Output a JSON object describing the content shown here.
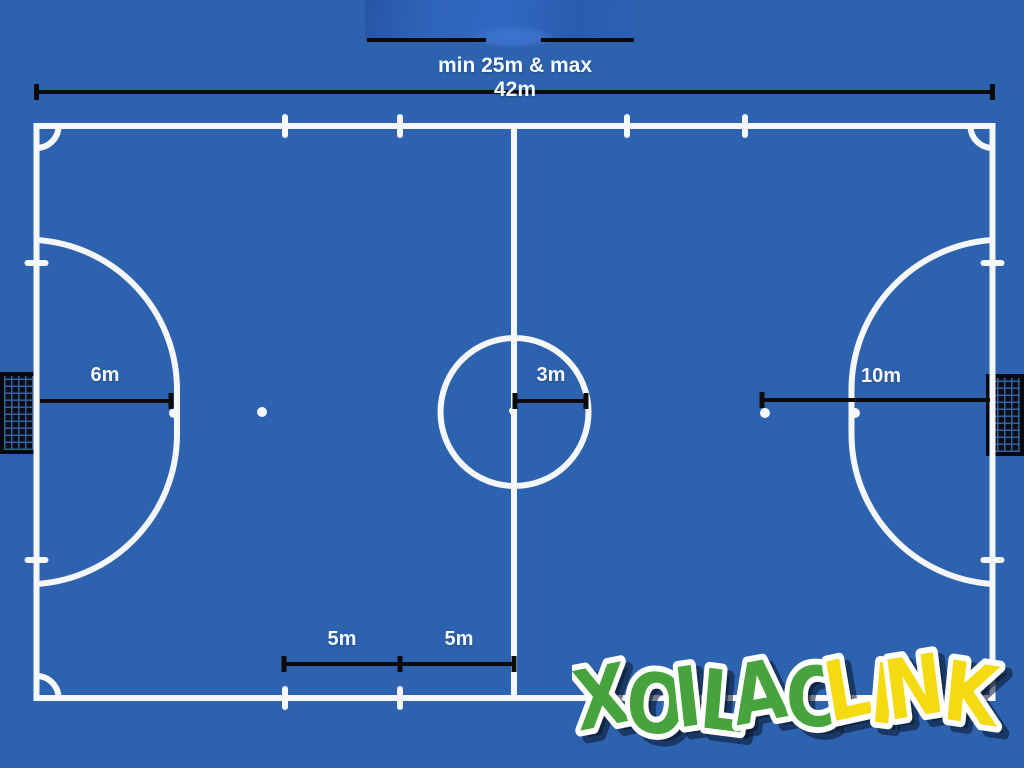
{
  "colors": {
    "background": "#2d63ae",
    "court_line_white": "#f5f7fa",
    "dimension_black": "#0b0b0c",
    "goal_frame_black": "#060a10",
    "goal_net_blue": "#35619f",
    "logo_green": "#47a33d",
    "logo_yellow": "#f3da11",
    "logo_outline": "#ffffff"
  },
  "dimensions": {
    "top_label": "min 25m & max 42m",
    "goal_arc_label": "6m",
    "center_circle_label": "3m",
    "second_penalty_label": "10m",
    "substitution_label_left": "5m",
    "substitution_label_right": "5m"
  },
  "watermark": {
    "text_primary": "XOILAC",
    "text_secondary": "LINK"
  }
}
